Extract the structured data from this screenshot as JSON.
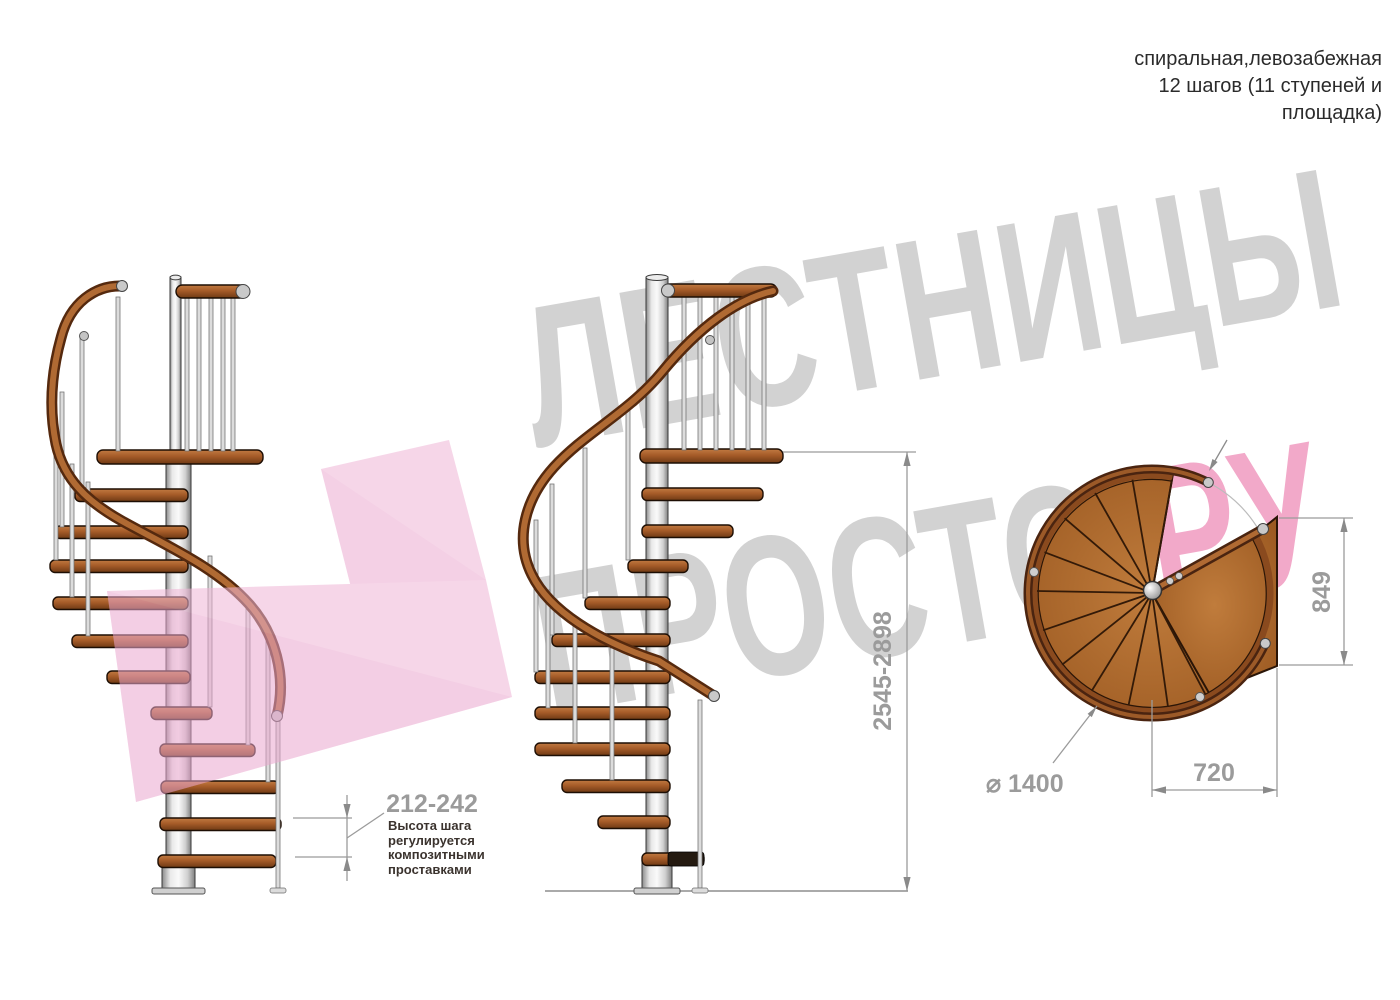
{
  "header": {
    "lines": [
      "спиральная,левозабежная",
      "12 шагов (11 ступеней и",
      "площадка)"
    ]
  },
  "watermark": {
    "word_top": "ЛЕСТНИЦЫ",
    "word_bottom": "ПРОСТО",
    "word_suffix": "РУ"
  },
  "dims": {
    "step_height": "212-242",
    "total_height": "2545-2898",
    "plan_depth": "849",
    "plan_width": "720",
    "plan_diameter": "⌀ 1400"
  },
  "note": {
    "lines": [
      "Высота шага",
      "регулируется",
      "композитными",
      "проставками"
    ]
  },
  "colors": {
    "wood": "#a55b28",
    "rail_dark": "#55290e",
    "rail_light": "#b06a33",
    "metal": "#dcdcdc",
    "dimension": "#9b9b9b",
    "text_dark": "#3b332e",
    "watermark_gray": "#d2d2d2",
    "watermark_pink": "#f2a9c9",
    "logo_pink": "#f0b6d7"
  }
}
